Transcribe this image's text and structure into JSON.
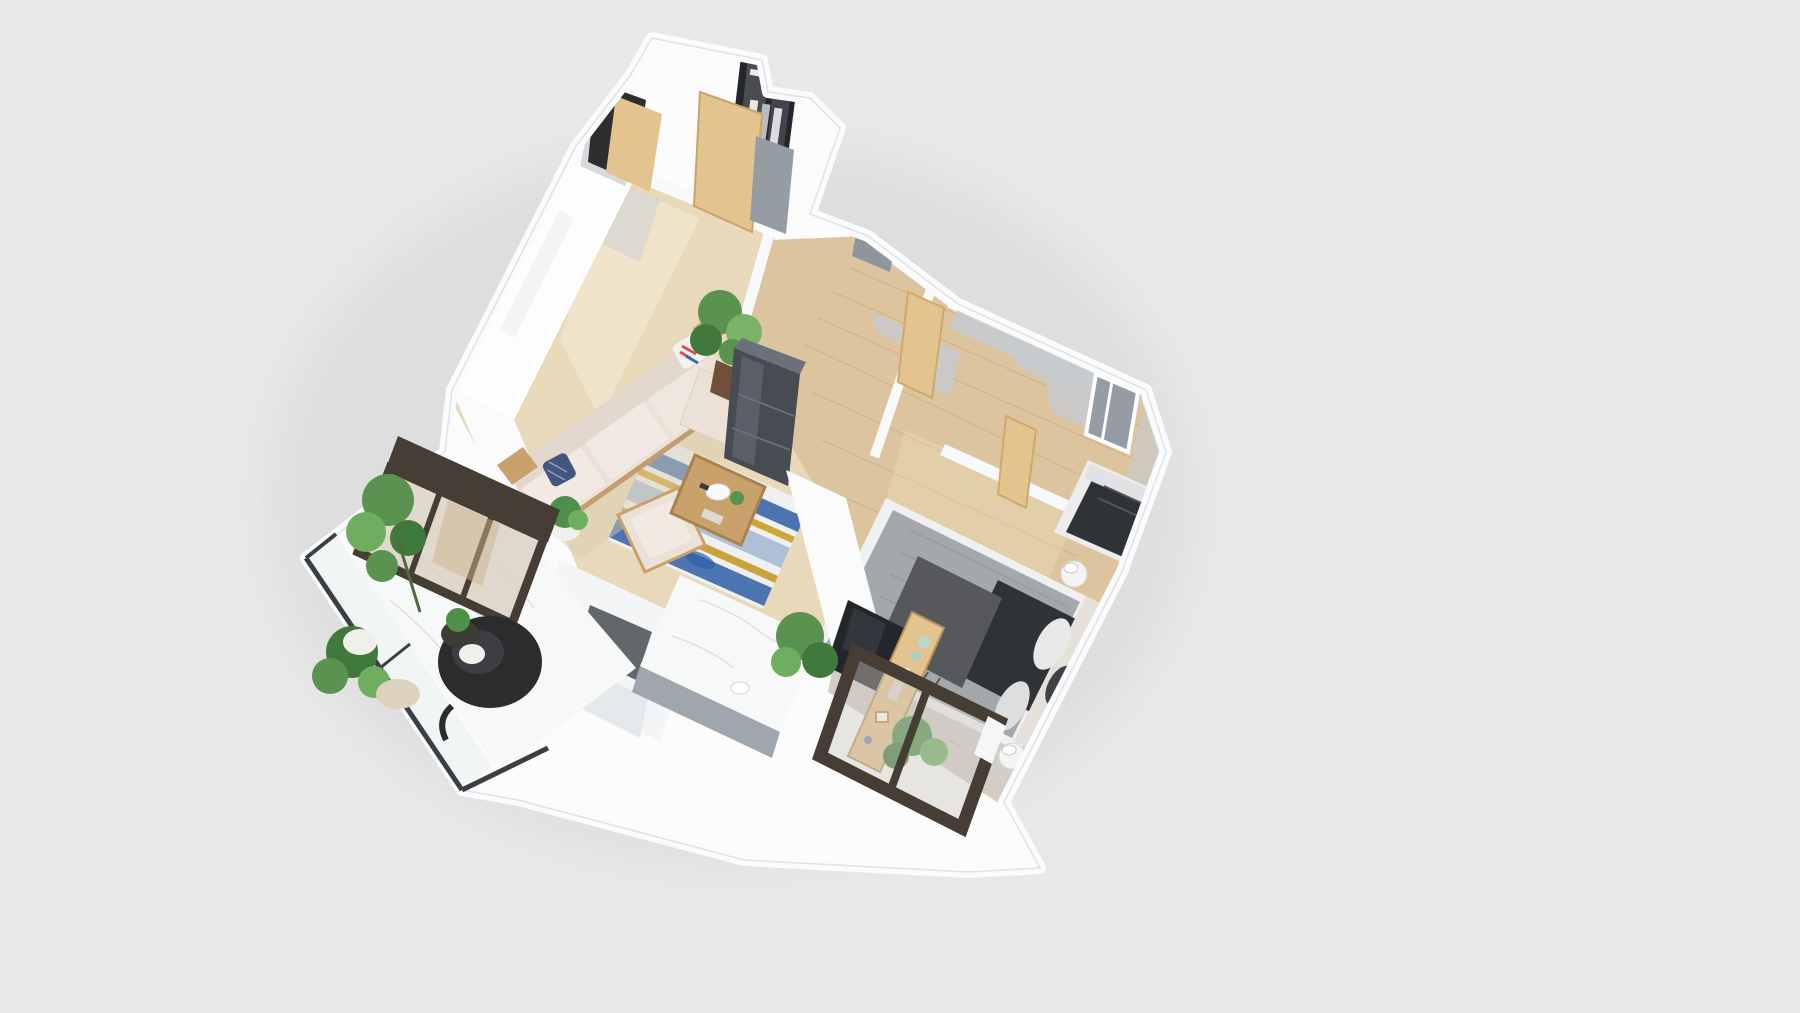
{
  "scene": {
    "description": "Photorealistic 3D dollhouse-style floor plan render of a small apartment, viewed from above at an oblique angle, centered on a plain light gray background",
    "view": "top-down perspective, plan rotated roughly 24 degrees clockwise",
    "background_color": "#e8e8e8",
    "no_visible_text": true
  },
  "palette": {
    "bg": "#e8e8e8",
    "slabWhite": "#fcfcfd",
    "wallWhite": "#f6f7f8",
    "wallShadow": "#c6cbd1",
    "floorTan": "#e8d9bb",
    "floorWood": "#dcc49e",
    "marble": "#f7f8f8",
    "rugBase": "#eef0f2",
    "rugBlue": "#4c74b0",
    "rugBlueLight": "#aebfd6",
    "rugGold": "#d0a636",
    "sofaCream": "#ece1d6",
    "sofaCushion": "#f2eae2",
    "woodLight": "#c9a26b",
    "woodDoor": "#e3c48f",
    "frameDark": "#463d35",
    "glassTint": "#d8cdbe",
    "darkCabinet": "#474b52",
    "tvBlack": "#23262a",
    "bedDuvet": "#a3a8ac",
    "bedThrow": "#56585c",
    "bedDark": "#2f3337",
    "bedBase": "#f0f0f0",
    "fluffyRug": "#d3cdc8",
    "foliage": "#5a9350",
    "foliageDark": "#3f7a3c",
    "foliageLight": "#79b368",
    "potWhite": "#f1efe9",
    "potDark": "#6e5138",
    "grayPanel": "#959ca3",
    "celadon": "#bcd9cf"
  },
  "rooms": [
    {
      "name": "entry-closet",
      "floor": "light",
      "contents": [
        "glass-front wardrobe with hanging clothes",
        "open black door",
        "open wood door panel",
        "gray panel"
      ]
    },
    {
      "name": "hallway",
      "floor": "oak planks",
      "contents": [
        "open wood doors",
        "wall shadows"
      ]
    },
    {
      "name": "living-room",
      "floor": "beige",
      "contents": [
        "cream sofa with pillows",
        "ottoman",
        "armchair",
        "wood coffee table with tray and plant",
        "blue and gold striped rug",
        "tall potted plant",
        "dark display cabinet"
      ]
    },
    {
      "name": "kitchen",
      "floor": "beige",
      "contents": [
        "white island with marble top",
        "white shelf unit with niche"
      ]
    },
    {
      "name": "balcony",
      "floor": "white marble",
      "contents": [
        "glass railing with dark rail",
        "hanging egg chair",
        "three potted plants",
        "dark framed sliding glass door"
      ]
    },
    {
      "name": "master-bedroom",
      "floor": "oak planks",
      "contents": [
        "double bed with gray striped duvet",
        "dark fringed throw",
        "charcoal blanket",
        "pillows and headboard",
        "fluffy rug",
        "wood media console with celadon ceramics and books",
        "tv panel on partition",
        "two round nightstands with lamps",
        "leafy plants",
        "dark framed window wall"
      ]
    },
    {
      "name": "second-bedroom",
      "floor": "oak planks",
      "contents": [
        "bed with dark duvet and light pillows",
        "gray wall window",
        "wall shadows"
      ]
    }
  ]
}
